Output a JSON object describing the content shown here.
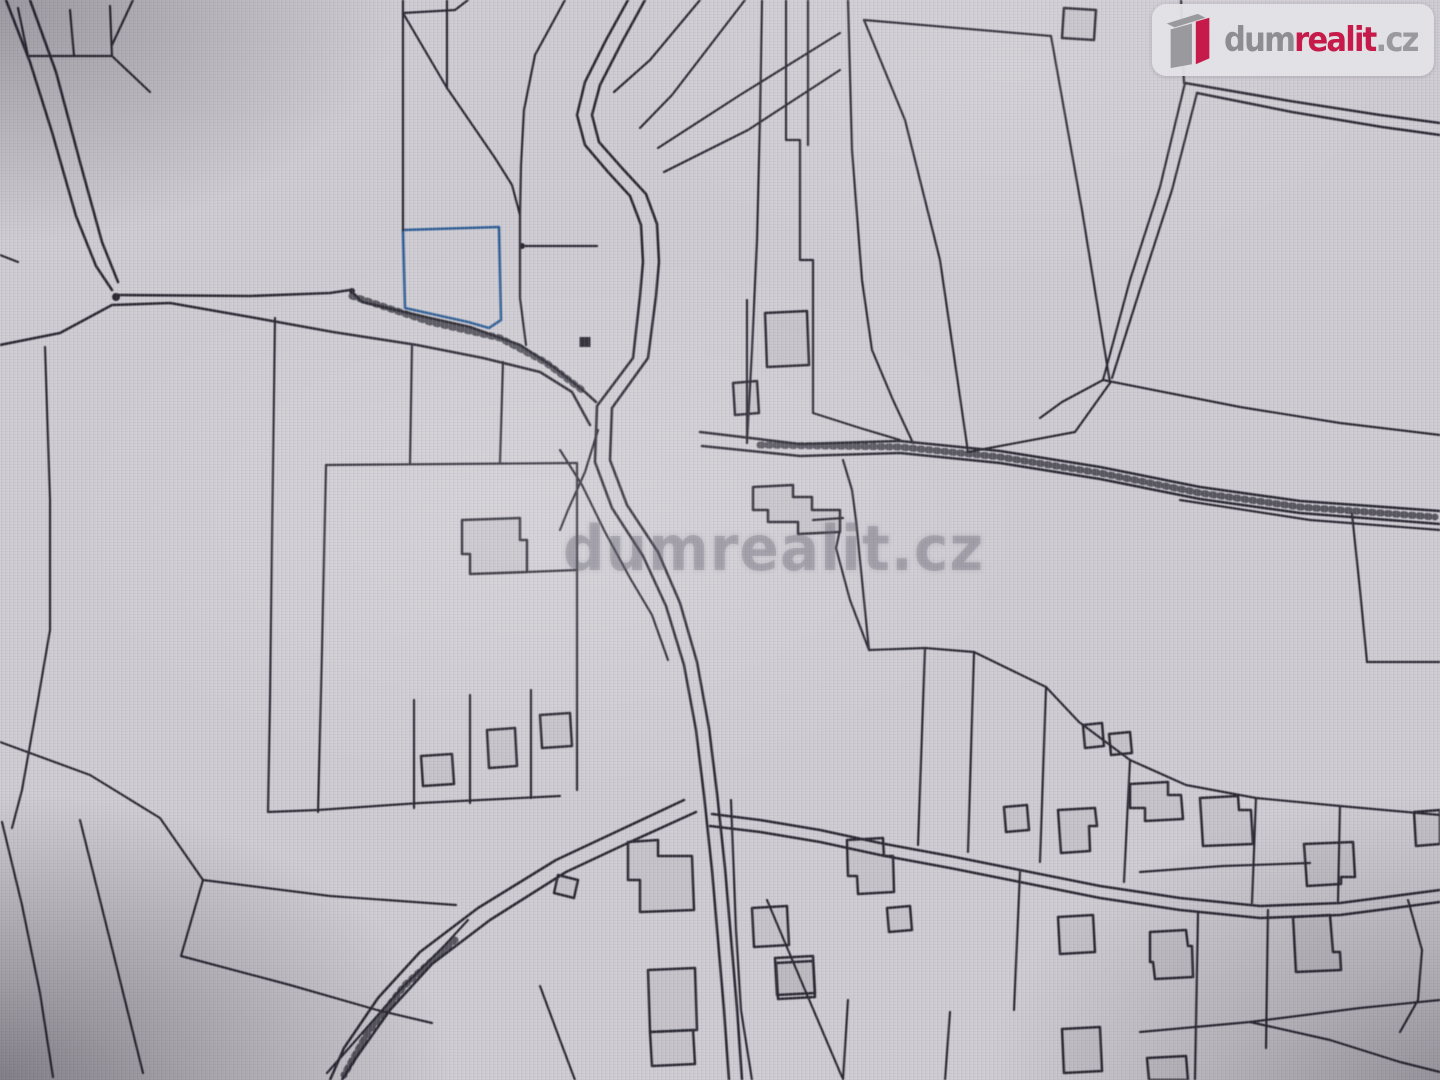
{
  "page": {
    "background": "#cfccd3",
    "description": "Photographed screen with cadastral parcel map, one parcel highlighted in blue"
  },
  "brand": {
    "name_gray": "dum",
    "name_red": "realit",
    "name_suffix": ".cz",
    "full_name": "dumrealit.cz",
    "red": "#c51a4a",
    "gray": "#8e8e92",
    "badge_bg": "rgba(227,226,230,0.95)"
  },
  "watermark": {
    "text": "dumrealit.cz"
  },
  "map": {
    "line_color": "#2b2933",
    "highlight": {
      "label": "highlighted-parcel",
      "fill": "#74a3d6",
      "stripe": "#5e8fc6",
      "stroke": "#2f5f97",
      "d": "M403,230 L499,227 L501,320 L489,328 L468,322 L405,308 Z"
    },
    "roads": [
      [
        "M118,295 L250,296 L330,293 L350,290 L362,302 L430,318 L470,327 L520,345 L555,368 L585,392 L596,402",
        "M0,345 L60,333 L112,305 L170,303 L250,317 L333,332 L417,345 L483,358 L540,372 L572,392 L590,425"
      ],
      [
        "M6,0 L30,62 L52,132 L76,216 L96,266 L112,290",
        "M30,0 L56,72 L80,162 L102,242 L118,282"
      ],
      [
        "M628,0 L606,40 L585,82 L577,115 L585,145 L608,172 L630,196 L641,225 L643,262 L640,296 L633,358 L597,406 L595,462 L612,508 L643,556 L666,606 L684,665 L696,730 L704,795 L712,870 L718,940 L724,1010 L729,1080",
        "M645,0 L622,42 L600,85 L592,115 L599,142 L622,168 L646,194 L657,224 L659,262 L656,296 L648,358 L612,408 L610,460 L627,505 L658,552 L680,603 L697,662 L709,728 L717,793 L725,868 L731,938 L737,1008 L742,1080"
      ],
      [
        "M700,432 L800,444 L900,441 L1000,451 L1100,467 L1200,487 L1300,501 L1440,511",
        "M702,446 L800,456 L900,453 L1000,463 L1100,479 L1200,499 L1300,513 L1440,524"
      ],
      [
        "M684,800 L620,830 L556,860 L478,908 L420,952 L378,998 L344,1048 L330,1080",
        "M696,812 L630,842 L566,872 L490,920 L432,964 L390,1010 L356,1058 L342,1080"
      ],
      [
        "M712,814 L760,820 L820,830 L880,843 L950,856 L1020,870 L1100,886 L1180,898 L1260,906 L1340,903 L1440,890",
        "M710,826 L760,832 L820,842 L880,855 L950,868 L1020,882 L1100,898 L1180,910 L1260,918 L1340,915 L1440,902"
      ],
      [
        "M1185,83 L1290,101 L1380,115 L1440,123",
        "M1197,93 L1292,112 L1382,127 L1440,135"
      ]
    ],
    "hatch_lines": [
      "M352,296 L430,322 L500,338 L545,362 L582,390",
      "M760,445 L900,447 L1000,457 L1100,473 L1200,493 L1300,507 L1435,517",
      "M455,940 L405,985 L368,1032 L344,1075"
    ],
    "parcel_lines": [
      "M18,8 L28,56 L112,56 L110,6",
      "M70,10 L74,56",
      "M112,56 L150,92",
      "M133,0 L112,45",
      "M0,255 L18,262",
      "M45,347 L50,500 L50,630 L38,700 L22,790 L12,828",
      "M0,742 L90,775 L160,818 L203,880",
      "M2,822 L22,905 L40,993 L53,1077",
      "M80,820 L110,940 L143,1073",
      "M203,880 L330,896 L456,905",
      "M203,880 L181,956 L290,985 L377,1010 L432,1023",
      "M327,1073 L400,990 L445,945 L468,920",
      "M326,465 L322,650 L318,812",
      "M326,465 L450,464 L577,463",
      "M577,463 L577,790",
      "M268,812 L318,810 L420,803 L560,796",
      "M414,700 L414,808",
      "M470,695 L470,803",
      "M531,690 L531,798",
      "M403,0 L403,230",
      "M403,13 L455,10 L468,0",
      "M403,13 L447,88 L495,158 L512,185 L520,215",
      "M447,0 L447,88",
      "M565,0 L535,55 L524,110 L521,165 L520,215 L520,298 L526,345",
      "M522,246 L597,246",
      "M700,0 L650,60 L614,92",
      "M745,0 L672,95 L640,128",
      "M840,33 L740,95 L658,148",
      "M840,70 L748,130 L664,172",
      "M786,0 L786,140 L800,140 L800,260 L813,260 L813,413",
      "M808,0 L808,145",
      "M762,0 L760,120 L757,240 L752,350 L747,443",
      "M848,0 L852,150 L862,280 L872,350 L893,400 L913,443",
      "M864,20 L905,120 L940,260 L968,452",
      "M864,20 L1051,36",
      "M1051,36 L1082,210 L1110,383",
      "M1110,383 L1075,432 L968,452",
      "M1185,83 L1160,187 L1130,280 L1103,380",
      "M1197,93 L1172,190 L1142,283 L1112,378",
      "M1103,380 L1240,407 L1340,423 L1440,435",
      "M1103,380 L1062,402 L1040,418",
      "M1181,0 L1184,83",
      "M1352,514 L1360,590 L1367,662",
      "M1367,662 L1440,662",
      "M1180,500 L1310,520 L1440,530",
      "M869,650 L925,648 L974,652 L1046,687 L1079,722 L1130,760 L1186,785 L1256,798 L1340,806 L1440,815",
      "M869,650 L850,600 L836,548 L840,530",
      "M843,460 L852,490 L856,520 L862,580 L869,650",
      "M925,648 L918,845",
      "M974,652 L968,852",
      "M1046,687 L1040,862",
      "M1130,760 L1124,882",
      "M1256,798 L1252,903",
      "M1340,806 L1338,901",
      "M1020,872 L1014,1010",
      "M1198,912 L1195,1080",
      "M1268,910 L1266,1048",
      "M1140,1032 L1250,1022 L1360,1008 L1440,1000",
      "M1250,1022 L1330,1040 L1400,1062 L1440,1072",
      "M1408,900 L1422,950 L1418,1000 L1400,1032",
      "M848,1000 L843,1080",
      "M950,1012 L945,1080",
      "M767,900 L805,990 L842,1077",
      "M731,800 L736,930 L741,1010 L752,1080",
      "M747,300 L747,443",
      "M813,413 L860,428 L900,440",
      "M275,318 L272,540 L270,700 L268,812",
      "M540,986 L560,1040 L575,1080",
      "M560,450 L582,485 L605,532 L630,578 L652,615 L668,660",
      "M813,520 L843,518",
      "M598,430 L585,472 L568,510 L560,530",
      "M527,572 L577,570",
      "M1140,872 L1223,866 L1310,863",
      "M412,346 L410,463",
      "M503,362 L500,463"
    ],
    "buildings": [
      "M462,520 L520,518 L520,540 L527,540 L527,572 L470,574 L470,554 L462,554 Z",
      "M421,756 L452,754 L454,784 L423,786 Z",
      "M487,730 L515,728 L517,766 L489,768 Z",
      "M540,715 L570,713 L572,746 L542,748 Z",
      "M628,842 L658,840 L658,856 L692,856 L694,910 L640,912 L640,880 L628,880 Z",
      "M558,875 L578,880 L574,898 L554,893 Z",
      "M648,970 L695,968 L697,1030 L650,1032 Z",
      "M650,1032 L693,1030 L695,1064 L652,1066 Z",
      "M752,908 L787,906 L789,945 L754,947 Z",
      "M775,958 L813,956 L815,993 L777,995 Z",
      "M847,840 L883,838 L884,856 L893,856 L894,892 L858,894 L857,876 L848,876 Z",
      "M887,908 L910,906 L912,930 L889,932 Z",
      "M753,487 L793,485 L793,497 L812,497 L812,510 L840,510 L840,532 L798,534 L798,522 L768,522 L768,510 L753,510 Z",
      "M733,383 L757,381 L759,413 L735,415 Z",
      "M765,313 L807,311 L809,365 L767,367 Z",
      "M1064,8 L1096,10 L1094,40 L1062,38 Z",
      "M1130,784 L1168,782 L1168,795 L1181,795 L1183,819 L1145,821 L1145,808 L1130,808 Z",
      "M1200,798 L1238,796 L1239,810 L1251,810 L1253,844 L1203,846 Z",
      "M1304,844 L1353,842 L1355,877 L1341,877 L1341,884 L1307,886 Z",
      "M1414,812 L1440,810 L1440,844 L1416,846 Z",
      "M1083,725 L1102,723 L1104,746 L1085,748 Z",
      "M1109,734 L1130,732 L1132,753 L1111,755 Z",
      "M1004,807 L1027,805 L1029,830 L1006,832 Z",
      "M1058,810 L1095,808 L1097,826 L1089,826 L1090,851 L1061,853 Z",
      "M1058,917 L1093,915 L1095,952 L1060,954 Z",
      "M1150,932 L1186,930 L1188,946 L1192,946 L1193,977 L1155,979 L1153,962 L1150,962 Z",
      "M1293,917 L1330,915 L1333,952 L1340,952 L1341,970 L1296,972 Z",
      "M1062,1029 L1100,1027 L1102,1071 L1064,1073 Z",
      "M1147,1058 L1186,1056 L1188,1080 L1149,1080 Z",
      "M776,963 L813,961 L815,997 L778,999 Z"
    ],
    "markers": [
      {
        "shape": "rect",
        "x": 585,
        "y": 342,
        "w": 11,
        "h": 10
      },
      {
        "shape": "circle",
        "x": 116,
        "y": 297,
        "r": 4
      },
      {
        "shape": "circle",
        "x": 522,
        "y": 246,
        "r": 3
      },
      {
        "shape": "circle",
        "x": 352,
        "y": 291,
        "r": 3
      }
    ]
  }
}
